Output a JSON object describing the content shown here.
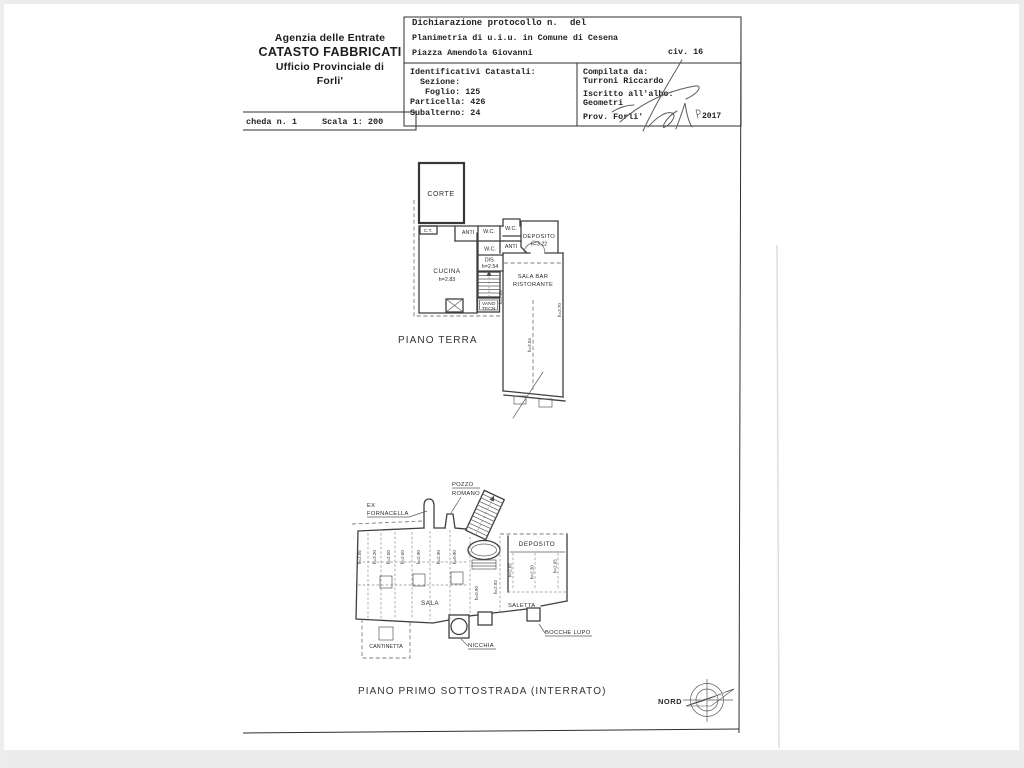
{
  "document": {
    "agency": {
      "line1": "Agenzia delle Entrate",
      "line2": "CATASTO FABBRICATI",
      "line3": "Ufficio Provinciale di",
      "line4": "Forli'"
    },
    "scheda": {
      "number": "cheda n. 1",
      "scale": "Scala 1: 200"
    },
    "declaration": {
      "protocol": "Dichiarazione protocollo n.",
      "del": "del",
      "planimetria": "Planimetria di u.i.u. in Comune di Cesena",
      "address": "Piazza Amendola Giovanni",
      "civ": "civ. 16"
    },
    "identificativi": {
      "title": "Identificativi Catastali:",
      "sezione": "Sezione:",
      "foglio": "Foglio: 125",
      "particella": "Particella: 426",
      "subalterno": "Subalterno: 24"
    },
    "compilata": {
      "title": "Compilata da:",
      "name": "Turroni Riccardo",
      "albo": "Iscritto all'albo:",
      "albo_value": "Geometri",
      "prov": "Prov. Forli'",
      "year": "2017"
    }
  },
  "piano_terra": {
    "title": "PIANO TERRA",
    "rooms": {
      "corte": "CORTE",
      "ct": "C.T.",
      "anti": "ANTI",
      "wc": "W.C.",
      "deposito": "DEPOSITO",
      "deposito_h": "h=3.22",
      "cucina": "CUCINA",
      "cucina_h": "h=2.83",
      "dis": "DIS.",
      "dis_h": "h=2.54",
      "sala_bar1": "SALA BAR",
      "sala_bar2": "RISTORANTE",
      "vano1": "VANO",
      "vano2": "TECN"
    },
    "heights": {
      "corridor": "h=3.04",
      "right_wall": "h=3.70",
      "left_wall": "h=2.04"
    }
  },
  "piano_interrato": {
    "title": "PIANO PRIMO SOTTOSTRADA (INTERRATO)",
    "rooms": {
      "pozzo1": "POZZO",
      "pozzo2": "ROMANO",
      "ex1": "EX",
      "ex2": "FORNACELLA",
      "deposito": "DEPOSITO",
      "sala": "SALA",
      "saletta": "SALETTA",
      "bocche_lupo": "BOCCHE LUPO",
      "nicchia": "NICCHIA",
      "cantinetta": "CANTINETTA"
    },
    "heights_sala": [
      "h=2.05",
      "h=3.20",
      "h=2.50",
      "h=2.50",
      "h=2.90",
      "h=2.90",
      "h=0.90"
    ],
    "heights_mid": [
      "h=0.90",
      "h=2.92"
    ],
    "heights_deposito": [
      "h=2.65",
      "h=2.30",
      "h=2.65"
    ]
  },
  "compass": {
    "label": "NORD"
  }
}
